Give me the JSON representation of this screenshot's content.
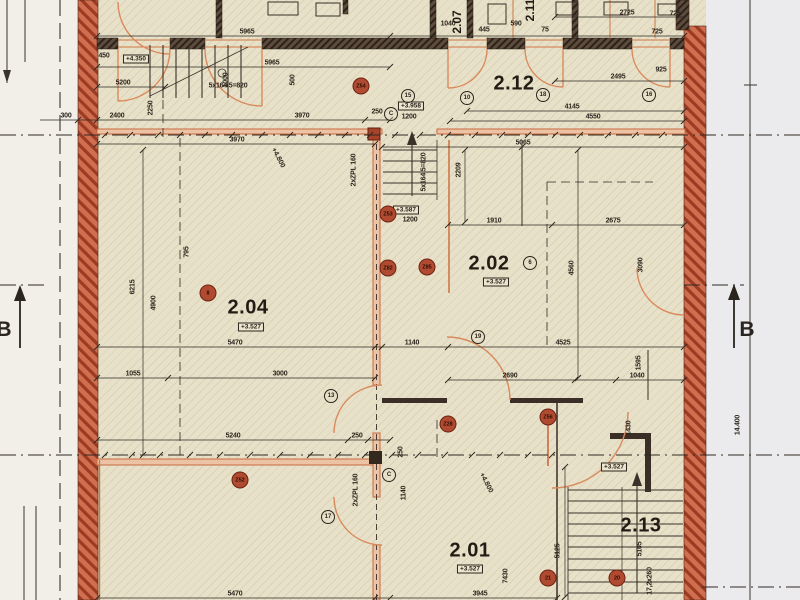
{
  "palette": {
    "paper": "#e8e1c9",
    "ink": "#2b251d",
    "brick": "#d06f50",
    "brickline": "#9c3a22",
    "darkwall": "#5d4c3c",
    "orange": "#cf7845",
    "orangefill": "#ecc3a4",
    "marginL": "#f1efe8",
    "marginR": "#ebebee",
    "markerred": "#b04a30"
  },
  "section_markers": {
    "left": "B",
    "right": "B"
  },
  "rooms": [
    {
      "id": "2.12",
      "x": 514,
      "y": 84
    },
    {
      "id": "2.04",
      "x": 248,
      "y": 308,
      "level": "+3.527",
      "lx": 251,
      "ly": 327
    },
    {
      "id": "2.02",
      "x": 489,
      "y": 264,
      "level": "+3.527",
      "lx": 496,
      "ly": 282
    },
    {
      "id": "2.01",
      "x": 470,
      "y": 551,
      "level": "+3.527",
      "lx": 470,
      "ly": 569
    },
    {
      "id": "2.13",
      "x": 641,
      "y": 526
    },
    {
      "id": "2.07",
      "x": 457,
      "y": 22,
      "r": -90,
      "sm": true
    },
    {
      "id": "2.11",
      "x": 530,
      "y": 10,
      "r": -90,
      "sm": true
    }
  ],
  "levels": [
    {
      "t": "+4.350",
      "x": 136,
      "y": 59
    },
    {
      "t": "+3.958",
      "x": 411,
      "y": 106,
      "sub": "1200",
      "sx": 409,
      "sy": 117
    },
    {
      "t": "+3.587",
      "x": 406,
      "y": 210,
      "sub": "1200",
      "sx": 410,
      "sy": 220
    },
    {
      "t": "+3.527",
      "x": 614,
      "y": 467
    }
  ],
  "notes": [
    {
      "t": "+4.800",
      "x": 278,
      "y": 158,
      "r": 62
    },
    {
      "t": "+4.800",
      "x": 486,
      "y": 483,
      "r": 62
    }
  ],
  "dimensions": [
    {
      "t": "5965",
      "x": 247,
      "y": 32
    },
    {
      "t": "725",
      "x": 657,
      "y": 32
    },
    {
      "t": "5965",
      "x": 272,
      "y": 63
    },
    {
      "t": "5200",
      "x": 123,
      "y": 83
    },
    {
      "t": "5x164,5=820",
      "x": 228,
      "y": 86
    },
    {
      "t": "450",
      "x": 104,
      "y": 56
    },
    {
      "t": "2725",
      "x": 627,
      "y": 13
    },
    {
      "t": "725",
      "x": 675,
      "y": 14
    },
    {
      "t": "2495",
      "x": 618,
      "y": 77
    },
    {
      "t": "925",
      "x": 661,
      "y": 70
    },
    {
      "t": "4145",
      "x": 572,
      "y": 107
    },
    {
      "t": "4550",
      "x": 593,
      "y": 117
    },
    {
      "t": "300",
      "x": 66,
      "y": 116
    },
    {
      "t": "2400",
      "x": 117,
      "y": 116
    },
    {
      "t": "3970",
      "x": 302,
      "y": 116
    },
    {
      "t": "250",
      "x": 377,
      "y": 112
    },
    {
      "t": "3970",
      "x": 237,
      "y": 140
    },
    {
      "t": "5065",
      "x": 523,
      "y": 143
    },
    {
      "t": "1910",
      "x": 494,
      "y": 221
    },
    {
      "t": "2675",
      "x": 613,
      "y": 221
    },
    {
      "t": "5470",
      "x": 235,
      "y": 343
    },
    {
      "t": "1140",
      "x": 412,
      "y": 343
    },
    {
      "t": "4525",
      "x": 563,
      "y": 343
    },
    {
      "t": "1055",
      "x": 133,
      "y": 374
    },
    {
      "t": "3000",
      "x": 280,
      "y": 374
    },
    {
      "t": "2690",
      "x": 510,
      "y": 376
    },
    {
      "t": "1040",
      "x": 637,
      "y": 376
    },
    {
      "t": "5240",
      "x": 233,
      "y": 436
    },
    {
      "t": "250",
      "x": 357,
      "y": 436
    },
    {
      "t": "5470",
      "x": 235,
      "y": 594
    },
    {
      "t": "3945",
      "x": 480,
      "y": 594
    },
    {
      "t": "445",
      "x": 484,
      "y": 30
    },
    {
      "t": "590",
      "x": 516,
      "y": 24
    },
    {
      "t": "75",
      "x": 545,
      "y": 30
    },
    {
      "t": "1040",
      "x": 448,
      "y": 24
    },
    {
      "t": "1000",
      "x": 226,
      "y": 80,
      "r": -90
    },
    {
      "t": "500",
      "x": 293,
      "y": 80,
      "r": -90
    },
    {
      "t": "2250",
      "x": 151,
      "y": 108,
      "r": -90
    },
    {
      "t": "2209",
      "x": 459,
      "y": 170,
      "r": -90
    },
    {
      "t": "5x164,5=820",
      "x": 424,
      "y": 172,
      "r": -90
    },
    {
      "t": "2xZPL 160",
      "x": 354,
      "y": 170,
      "r": -90
    },
    {
      "t": "2xZPL 160",
      "x": 356,
      "y": 490,
      "r": -90
    },
    {
      "t": "6215",
      "x": 133,
      "y": 287,
      "r": -90
    },
    {
      "t": "4900",
      "x": 154,
      "y": 303,
      "r": -90
    },
    {
      "t": "795",
      "x": 187,
      "y": 252,
      "r": -90
    },
    {
      "t": "4560",
      "x": 572,
      "y": 268,
      "r": -90
    },
    {
      "t": "3090",
      "x": 641,
      "y": 265,
      "r": -90
    },
    {
      "t": "1595",
      "x": 639,
      "y": 363,
      "r": -90
    },
    {
      "t": "1430",
      "x": 629,
      "y": 428,
      "r": -90
    },
    {
      "t": "1140",
      "x": 404,
      "y": 493,
      "r": -90
    },
    {
      "t": "250",
      "x": 401,
      "y": 452,
      "r": -90
    },
    {
      "t": "5125",
      "x": 558,
      "y": 551,
      "r": -90
    },
    {
      "t": "5105",
      "x": 640,
      "y": 549,
      "r": -90
    },
    {
      "t": "7430",
      "x": 506,
      "y": 576,
      "r": -90
    },
    {
      "t": "17,2x260",
      "x": 650,
      "y": 581,
      "r": -90
    },
    {
      "t": "14.400",
      "x": 738,
      "y": 425,
      "r": -90
    }
  ],
  "markers_red": [
    {
      "t": "Z54",
      "x": 361,
      "y": 86
    },
    {
      "t": "Z53",
      "x": 388,
      "y": 214
    },
    {
      "t": "Z82",
      "x": 388,
      "y": 268
    },
    {
      "t": "Z85",
      "x": 427,
      "y": 267
    },
    {
      "t": "Z28",
      "x": 448,
      "y": 424
    },
    {
      "t": "Z52",
      "x": 240,
      "y": 480
    },
    {
      "t": "Z56",
      "x": 548,
      "y": 417
    },
    {
      "t": "21",
      "x": 548,
      "y": 578
    },
    {
      "t": "20",
      "x": 617,
      "y": 578
    },
    {
      "t": "8",
      "x": 208,
      "y": 293
    }
  ],
  "markers_circled": [
    {
      "t": "10",
      "x": 467,
      "y": 98
    },
    {
      "t": "18",
      "x": 543,
      "y": 95
    },
    {
      "t": "16",
      "x": 649,
      "y": 95
    },
    {
      "t": "15",
      "x": 408,
      "y": 96
    },
    {
      "t": "6",
      "x": 530,
      "y": 263
    },
    {
      "t": "13",
      "x": 331,
      "y": 396
    },
    {
      "t": "17",
      "x": 328,
      "y": 517
    },
    {
      "t": "19",
      "x": 478,
      "y": 337
    },
    {
      "t": "C",
      "x": 391,
      "y": 114
    },
    {
      "t": "C",
      "x": 389,
      "y": 475
    }
  ]
}
